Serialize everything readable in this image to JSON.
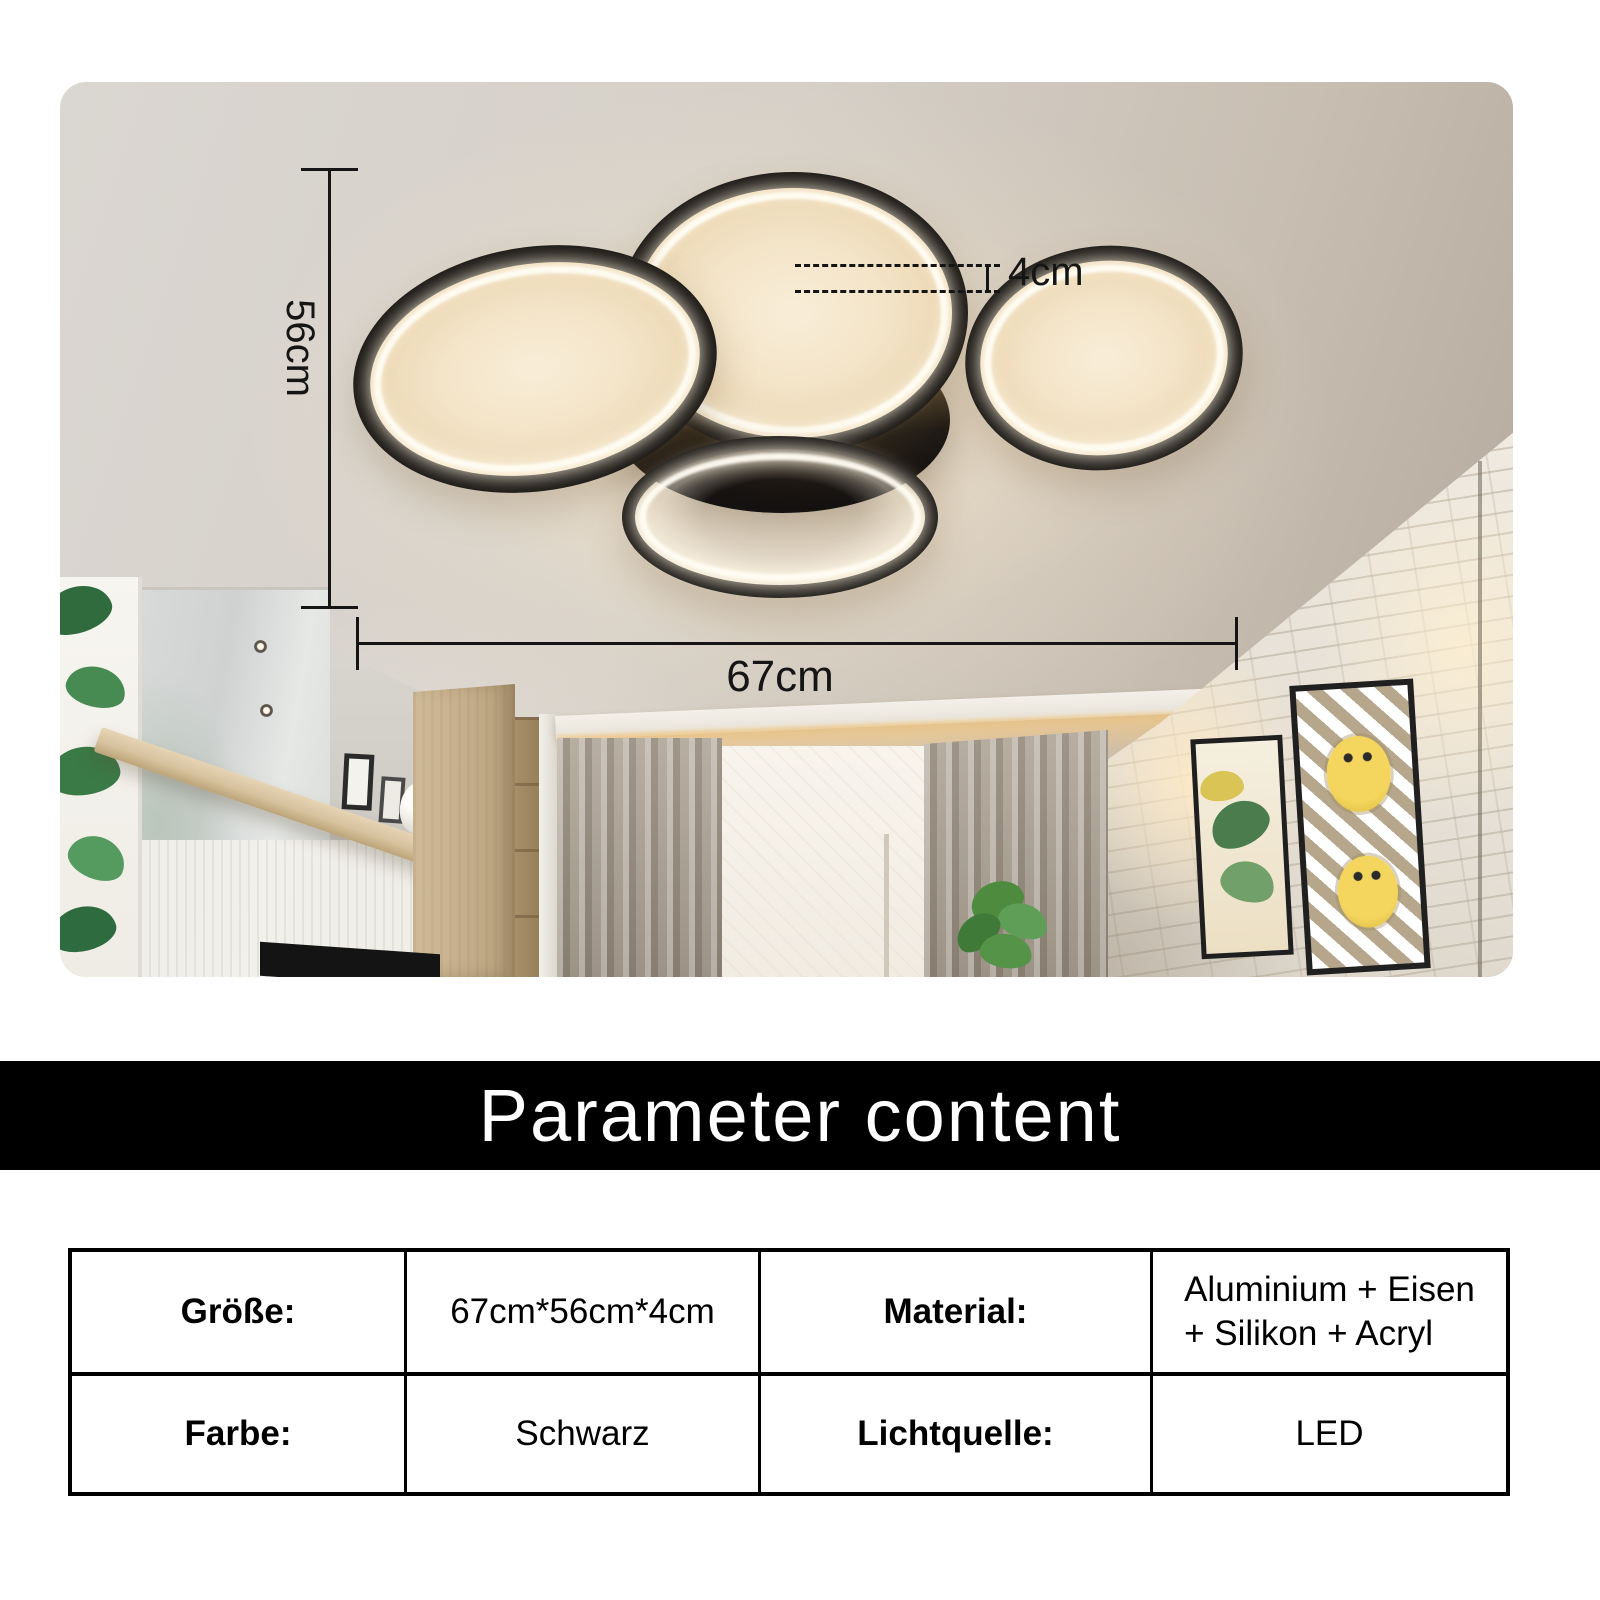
{
  "photo": {
    "dims": {
      "height": "56cm",
      "width": "67cm",
      "depth": "4cm"
    }
  },
  "banner": {
    "title": "Parameter content"
  },
  "table": {
    "rows": [
      {
        "cells": [
          {
            "label": "Größe:",
            "value": "67cm*56cm*4cm"
          },
          {
            "label": "Material:",
            "value": "Aluminium + Eisen\n+ Silikon + Acryl"
          }
        ]
      },
      {
        "cells": [
          {
            "label": "Farbe:",
            "value": "Schwarz"
          },
          {
            "label": "Lichtquelle:",
            "value": "LED"
          }
        ]
      }
    ]
  },
  "colors": {
    "banner_bg": "#000000",
    "banner_text": "#ffffff",
    "annotation": "#151515",
    "lamp_black": "#1b1815",
    "led_warm": "#f4e5c9"
  }
}
